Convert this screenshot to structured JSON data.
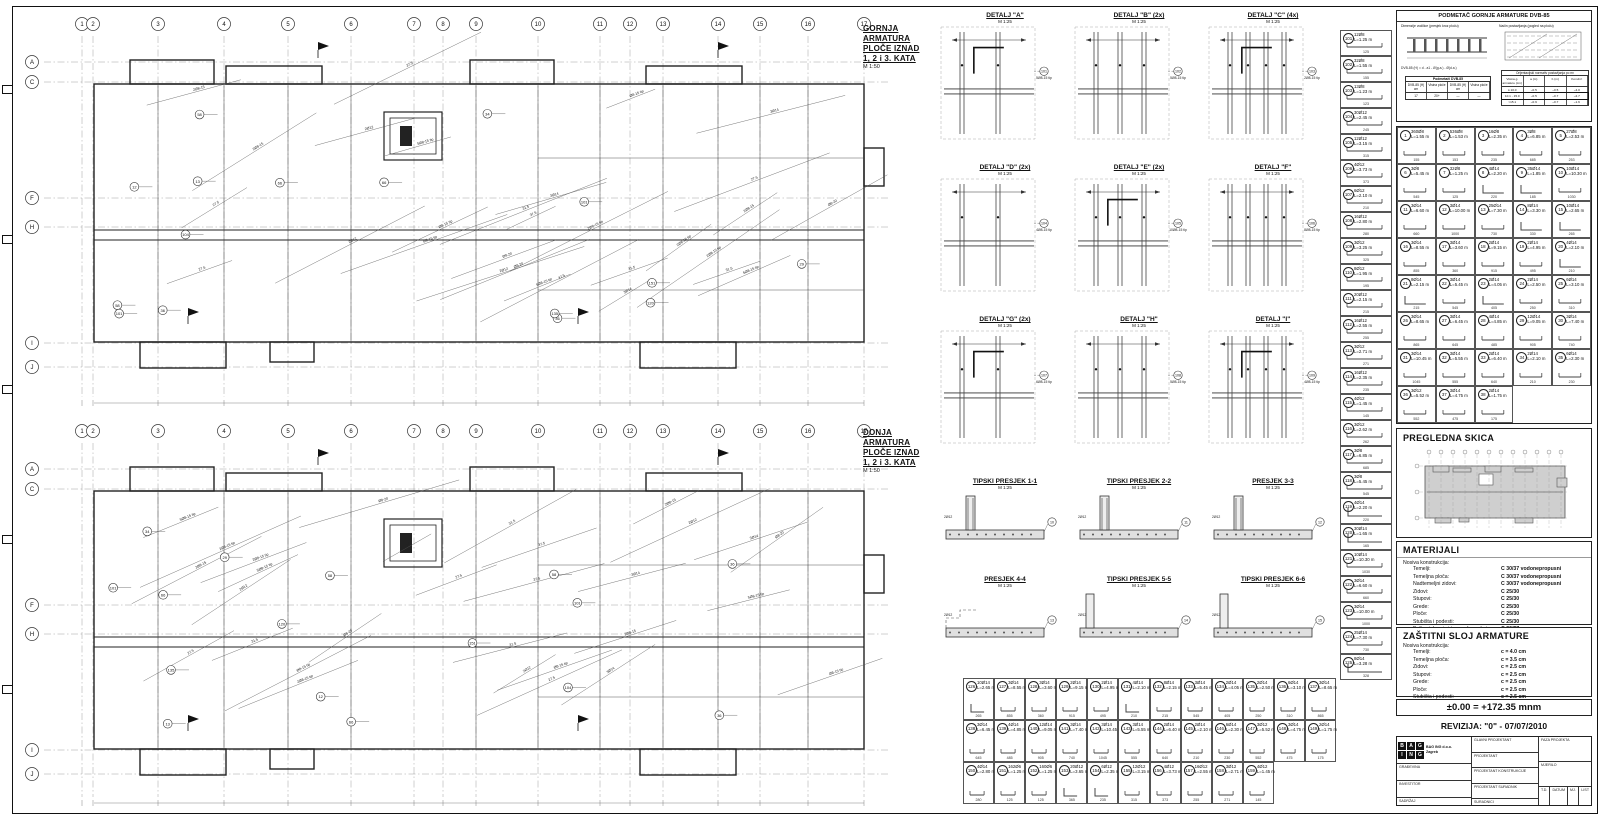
{
  "plans": [
    {
      "title_lines": [
        "GORNJA ARMATURA",
        "PLOČE IZNAD",
        "1, 2 i 3. KATA"
      ],
      "scale": "M 1:50"
    },
    {
      "title_lines": [
        "DONJA ARMATURA",
        "PLOČE IZNAD",
        "1, 2 i 3. KATA"
      ],
      "scale": "M 1:50"
    }
  ],
  "grid": {
    "cols": [
      "1",
      "2",
      "3",
      "4",
      "5",
      "6",
      "7",
      "8",
      "9",
      "10",
      "11",
      "12",
      "13",
      "14",
      "15",
      "16",
      "17"
    ],
    "rows": [
      "A",
      "C",
      "F",
      "H",
      "I",
      "J"
    ]
  },
  "plan_annotations": [
    "2Ø8-15 tip",
    "5Ø8-15 tip",
    "Ø8-15 tip",
    "3Ø14",
    "2Ø12",
    "37.5",
    "31.5",
    "27.5",
    "Ø8-20",
    "2Ø8-15"
  ],
  "plan_tags": [
    "58",
    "36",
    "66",
    "101",
    "104",
    "135",
    "13",
    "29",
    "120",
    "151",
    "12",
    "34"
  ],
  "details": [
    {
      "title": "DETALJ \"A\"",
      "scale": "M 1:25",
      "tag": "5Ø8-15 tip"
    },
    {
      "title": "DETALJ \"B\" (2x)",
      "scale": "M 1:25",
      "tag": "5Ø8-15 tip"
    },
    {
      "title": "DETALJ \"C\" (4x)",
      "scale": "M 1:25",
      "tag": "2Ø8-15 tip"
    },
    {
      "title": "DETALJ \"D\" (2x)",
      "scale": "M 1:25",
      "tag": "4Ø8-15 tip"
    },
    {
      "title": "DETALJ \"E\" (2x)",
      "scale": "M 1:25",
      "tag": "10Ø8-15 tip"
    },
    {
      "title": "DETALJ \"F\"",
      "scale": "M 1:25",
      "tag": "8Ø8-15 tip"
    },
    {
      "title": "DETALJ \"G\" (2x)",
      "scale": "M 1:25",
      "tag": "6Ø8-15 tip"
    },
    {
      "title": "DETALJ \"H\"",
      "scale": "M 1:25",
      "tag": "5Ø8-15 tip"
    },
    {
      "title": "DETALJ \"I\"",
      "scale": "M 1:25",
      "tag": "4Ø8-15 tip"
    }
  ],
  "sections": [
    {
      "title": "TIPSKI PRESJEK 1-1",
      "scale": "M 1:25"
    },
    {
      "title": "TIPSKI PRESJEK 2-2",
      "scale": "M 1:25"
    },
    {
      "title": "PRESJEK 3-3",
      "scale": "M 1:25"
    },
    {
      "title": "PRESJEK 4-4",
      "scale": "M 1:25"
    },
    {
      "title": "TIPSKI PRESJEK 5-5",
      "scale": "M 1:25"
    },
    {
      "title": "TIPSKI PRESJEK 6-6",
      "scale": "M 1:25"
    }
  ],
  "schedule_main": {
    "items": [
      {
        "no": "1",
        "mark": "360Ø8",
        "len": "L=1.55 m"
      },
      {
        "no": "2",
        "mark": "536Ø8",
        "len": "L=1.53 m"
      },
      {
        "no": "3",
        "mark": "16Ø8",
        "len": "L=2.35 m"
      },
      {
        "no": "4",
        "mark": "3Ø8",
        "len": "L=6.85 m"
      },
      {
        "no": "5",
        "mark": "27Ø8",
        "len": "L=2.53 m"
      },
      {
        "no": "6",
        "mark": "3Ø8",
        "len": "L=5.45 m"
      },
      {
        "no": "7",
        "mark": "32Ø8",
        "len": "L=1.25 m"
      },
      {
        "no": "8",
        "mark": "4Ø14",
        "len": "L=2.20 m",
        "shape": "L"
      },
      {
        "no": "9",
        "mark": "35Ø14",
        "len": "L=1.85 m",
        "shape": "L"
      },
      {
        "no": "10",
        "mark": "10Ø14",
        "len": "L=10.30 m"
      },
      {
        "no": "11",
        "mark": "3Ø14",
        "len": "L=6.60 m"
      },
      {
        "no": "12",
        "mark": "3Ø14",
        "len": "L=10.00 m"
      },
      {
        "no": "13",
        "mark": "25Ø14",
        "len": "L=7.30 m"
      },
      {
        "no": "14",
        "mark": "8Ø14",
        "len": "L=3.30 m",
        "shape": "L"
      },
      {
        "no": "15",
        "mark": "10Ø14",
        "len": "L=2.65 m",
        "shape": "L"
      },
      {
        "no": "16",
        "mark": "3Ø14",
        "len": "L=8.55 m"
      },
      {
        "no": "17",
        "mark": "3Ø14",
        "len": "L=3.60 m"
      },
      {
        "no": "18",
        "mark": "2Ø14",
        "len": "L=9.15 m"
      },
      {
        "no": "19",
        "mark": "2Ø14",
        "len": "L=4.95 m"
      },
      {
        "no": "20",
        "mark": "4Ø14",
        "len": "L=2.10 m",
        "shape": "L"
      },
      {
        "no": "21",
        "mark": "8Ø14",
        "len": "L=2.15 m",
        "shape": "L"
      },
      {
        "no": "22",
        "mark": "3Ø14",
        "len": "L=5.45 m"
      },
      {
        "no": "23",
        "mark": "2Ø14",
        "len": "L=4.05 m",
        "shape": "L"
      },
      {
        "no": "24",
        "mark": "2Ø14",
        "len": "L=2.50 m"
      },
      {
        "no": "25",
        "mark": "6Ø14",
        "len": "L=3.10 m"
      },
      {
        "no": "26",
        "mark": "3Ø14",
        "len": "L=8.65 m"
      },
      {
        "no": "27",
        "mark": "3Ø14",
        "len": "L=6.45 m"
      },
      {
        "no": "28",
        "mark": "4Ø14",
        "len": "L=4.85 m"
      },
      {
        "no": "29",
        "mark": "12Ø14",
        "len": "L=9.05 m"
      },
      {
        "no": "30",
        "mark": "3Ø14",
        "len": "L=7.40 m"
      },
      {
        "no": "31",
        "mark": "3Ø14",
        "len": "L=10.45 m"
      },
      {
        "no": "32",
        "mark": "3Ø14",
        "len": "L=5.55 m"
      },
      {
        "no": "33",
        "mark": "2Ø14",
        "len": "L=6.40 m"
      },
      {
        "no": "34",
        "mark": "2Ø14",
        "len": "L=2.10 m"
      },
      {
        "no": "35",
        "mark": "6Ø14",
        "len": "L=2.30 m"
      },
      {
        "no": "36",
        "mark": "3Ø12",
        "len": "L=5.52 m"
      },
      {
        "no": "37",
        "mark": "3Ø14",
        "len": "L=4.75 m"
      },
      {
        "no": "38",
        "mark": "2Ø14",
        "len": "L=1.75 m"
      }
    ]
  },
  "schedule_strip": {
    "items": [
      {
        "no": "101",
        "mark": "12Ø8",
        "len": "L=1.25 m"
      },
      {
        "no": "102",
        "mark": "32Ø8",
        "len": "L=1.55 m"
      },
      {
        "no": "103",
        "mark": "13Ø8",
        "len": "L=1.23 m"
      },
      {
        "no": "104",
        "mark": "30Ø12",
        "len": "L=2.45 m"
      },
      {
        "no": "105",
        "mark": "12Ø12",
        "len": "L=3.15 m"
      },
      {
        "no": "106",
        "mark": "4Ø12",
        "len": "L=3.73 m"
      },
      {
        "no": "107",
        "mark": "6Ø12",
        "len": "L=2.10 m"
      },
      {
        "no": "108",
        "mark": "16Ø12",
        "len": "L=2.80 m"
      },
      {
        "no": "109",
        "mark": "3Ø12",
        "len": "L=3.25 m"
      },
      {
        "no": "110",
        "mark": "8Ø12",
        "len": "L=1.95 m"
      },
      {
        "no": "111",
        "mark": "20Ø12",
        "len": "L=2.15 m"
      },
      {
        "no": "112",
        "mark": "16Ø12",
        "len": "L=2.55 m"
      },
      {
        "no": "113",
        "mark": "3Ø12",
        "len": "L=2.71 m"
      },
      {
        "no": "114",
        "mark": "16Ø12",
        "len": "L=2.35 m"
      },
      {
        "no": "115",
        "mark": "4Ø12",
        "len": "L=1.45 m"
      },
      {
        "no": "116",
        "mark": "3Ø12",
        "len": "L=2.62 m"
      },
      {
        "no": "117",
        "mark": "3Ø8",
        "len": "L=6.85 m"
      },
      {
        "no": "118",
        "mark": "3Ø8",
        "len": "L=5.45 m"
      },
      {
        "no": "119",
        "mark": "4Ø14",
        "len": "L=2.20 m",
        "shape": "L"
      },
      {
        "no": "120",
        "mark": "30Ø14",
        "len": "L=1.65 m",
        "shape": "L"
      },
      {
        "no": "121",
        "mark": "10Ø14",
        "len": "L=10.30 m"
      },
      {
        "no": "122",
        "mark": "3Ø14",
        "len": "L=6.60 m"
      },
      {
        "no": "123",
        "mark": "3Ø14",
        "len": "L=10.00 m"
      },
      {
        "no": "124",
        "mark": "25Ø14",
        "len": "L=7.30 m"
      },
      {
        "no": "125",
        "mark": "8Ø14",
        "len": "L=3.28 m",
        "shape": "L"
      }
    ]
  },
  "schedule_bottom": {
    "rows": [
      [
        {
          "no": "126",
          "mark": "10Ø14",
          "len": "L=2.65 m",
          "shape": "L"
        },
        {
          "no": "127",
          "mark": "3Ø14",
          "len": "L=8.55 m"
        },
        {
          "no": "128",
          "mark": "3Ø14",
          "len": "L=3.60 m"
        },
        {
          "no": "129",
          "mark": "2Ø14",
          "len": "L=9.15 m"
        },
        {
          "no": "130",
          "mark": "2Ø14",
          "len": "L=4.95 m"
        },
        {
          "no": "131",
          "mark": "4Ø14",
          "len": "L=2.10 m",
          "shape": "L"
        },
        {
          "no": "132",
          "mark": "8Ø14",
          "len": "L=2.15 m"
        },
        {
          "no": "133",
          "mark": "3Ø14",
          "len": "L=5.45 m"
        },
        {
          "no": "134",
          "mark": "2Ø14",
          "len": "L=4.05 m"
        },
        {
          "no": "135",
          "mark": "2Ø14",
          "len": "L=2.50 m"
        },
        {
          "no": "136",
          "mark": "6Ø14",
          "len": "L=3.10 m"
        },
        {
          "no": "137",
          "mark": "3Ø14",
          "len": "L=8.65 m"
        }
      ],
      [
        {
          "no": "138",
          "mark": "3Ø14",
          "len": "L=6.45 m"
        },
        {
          "no": "139",
          "mark": "4Ø14",
          "len": "L=4.85 m"
        },
        {
          "no": "140",
          "mark": "12Ø14",
          "len": "L=9.05 m"
        },
        {
          "no": "141",
          "mark": "3Ø14",
          "len": "L=7.40 m"
        },
        {
          "no": "142",
          "mark": "3Ø14",
          "len": "L=10.45 m"
        },
        {
          "no": "143",
          "mark": "3Ø14",
          "len": "L=5.55 m"
        },
        {
          "no": "144",
          "mark": "2Ø14",
          "len": "L=6.40 m"
        },
        {
          "no": "145",
          "mark": "2Ø14",
          "len": "L=2.10 m"
        },
        {
          "no": "146",
          "mark": "6Ø14",
          "len": "L=2.30 m"
        },
        {
          "no": "147",
          "mark": "3Ø12",
          "len": "L=5.52 m"
        },
        {
          "no": "148",
          "mark": "3Ø14",
          "len": "L=4.75 m"
        },
        {
          "no": "149",
          "mark": "2Ø14",
          "len": "L=1.75 m"
        }
      ],
      [
        {
          "no": "150",
          "mark": "4Ø14",
          "len": "L=2.80 m"
        },
        {
          "no": "151",
          "mark": "162Ø6",
          "len": "L=1.25 m"
        },
        {
          "no": "152",
          "mark": "160Ø6",
          "len": "L=1.25 m"
        },
        {
          "no": "153",
          "mark": "20Ø12",
          "len": "L=3.65 m",
          "shape": "L"
        },
        {
          "no": "154",
          "mark": "6Ø12",
          "len": "L=2.35 m",
          "shape": "L"
        },
        {
          "no": "155",
          "mark": "12Ø12",
          "len": "L=3.15 m"
        },
        {
          "no": "156",
          "mark": "4Ø12",
          "len": "L=3.73 m"
        },
        {
          "no": "157",
          "mark": "16Ø12",
          "len": "L=2.55 m"
        },
        {
          "no": "158",
          "mark": "3Ø12",
          "len": "L=2.71 m"
        },
        {
          "no": "159",
          "mark": "4Ø12",
          "len": "L=1.45 m"
        }
      ]
    ]
  },
  "podmetac": {
    "title": "PODMETAČ GORNJE ARMATURE DVB-85",
    "left_caption": "Dimenzije vodilice (presjek kroz ploču)",
    "right_caption": "Način postavljanja (pogled na ploču)",
    "note": "DVB-85 (H) = d - a1 - Ø(g.a.) - Ø(d.a.)",
    "left_table_title": "Podmetači DVB-85",
    "left_table_headers": [
      "DVB-85 (H) cm",
      "Visina ploče",
      "DVB-85 (H) cm",
      "Visina ploče"
    ],
    "left_table_row": [
      "17",
      "20+",
      "—",
      "—"
    ],
    "right_table_title": "Orijentacijski normativ postavljanja po m²",
    "right_table_headers": [
      "Visina g. armature (cm)",
      "a (m)",
      "b (m)",
      "Kom/m²"
    ],
    "right_table_rows": [
      [
        "≤ 10.0",
        "~0.5",
        "~0.5",
        "~4.0"
      ],
      [
        "10.1 - 15.0",
        "~0.5",
        "~0.7",
        "~2.7"
      ],
      [
        ">15.1",
        "~0.9",
        "~0.7",
        "~1.6"
      ]
    ],
    "highlight_row": 1
  },
  "pregledna": {
    "title": "PREGLEDNA SKICA"
  },
  "materijali": {
    "title": "MATERIJALI",
    "subtitle": "Nosiva konstrukcija:",
    "rows": [
      [
        "Temelji:",
        "C 30/37 vodonepropusni"
      ],
      [
        "Temeljna ploča:",
        "C 30/37 vodonepropusni"
      ],
      [
        "Nadtemeljni zidovi:",
        "C 30/37 vodonepropusni"
      ],
      [
        "Zidovi:",
        "C 25/30"
      ],
      [
        "Stupovi:",
        "C 25/30"
      ],
      [
        "Grede:",
        "C 25/30"
      ],
      [
        "Ploče:",
        "C 25/30"
      ],
      [
        "Stubišta i podesti:",
        "C 25/30"
      ],
      [
        "Balkoni, loggie i terase (ograde i ploče):",
        "C 30/37"
      ],
      [
        "Ploče iznad otv. dizala i izlaza na krov:",
        "C 25/30"
      ],
      [
        "Armatura:",
        "B 500B"
      ],
      [
        "Čelik:",
        "S 235 JR"
      ]
    ]
  },
  "zastitni": {
    "title": "ZAŠTITNI SLOJ ARMATURE",
    "subtitle": "Nosiva konstrukcija:",
    "rows": [
      [
        "Temelji:",
        "c = 4.0 cm"
      ],
      [
        "Temeljna ploča:",
        "c = 3.5 cm"
      ],
      [
        "Zidovi:",
        "c = 2.5 cm"
      ],
      [
        "Stupovi:",
        "c = 2.5 cm"
      ],
      [
        "Grede:",
        "c = 2.5 cm"
      ],
      [
        "Ploče:",
        "c = 2.5 cm"
      ],
      [
        "Stubišta i podesti:",
        "c = 2.5 cm"
      ]
    ]
  },
  "elevation": "±0.00 = +172.35 mnm",
  "revision": "REVIZIJA: \"0\" - 07/07/2010",
  "titleblock": {
    "logo_letters": [
      "B",
      "A",
      "G",
      "I",
      "N",
      "G"
    ],
    "company_lines": [
      "BAG ING d.o.o.",
      "Zagreb"
    ],
    "gradjevina": "GRAĐEVINA",
    "investitor": "INVESTITOR",
    "sadrzaj": "SADRŽAJ",
    "glavni": "GLAVNI PROJEKTANT",
    "projektant": "PROJEKTANT",
    "konstrukcije": "PROJEKTANT KONSTRUKCIJE",
    "suradnik": "PROJEKTANT SURADNIK",
    "suradnici": "SURADNICI",
    "faza": "FAZA PROJEKTA",
    "mjerilo": "MJERILO",
    "td": "T.D.",
    "datum": "DATUM",
    "mj": "MJ.",
    "list": "LIST"
  }
}
